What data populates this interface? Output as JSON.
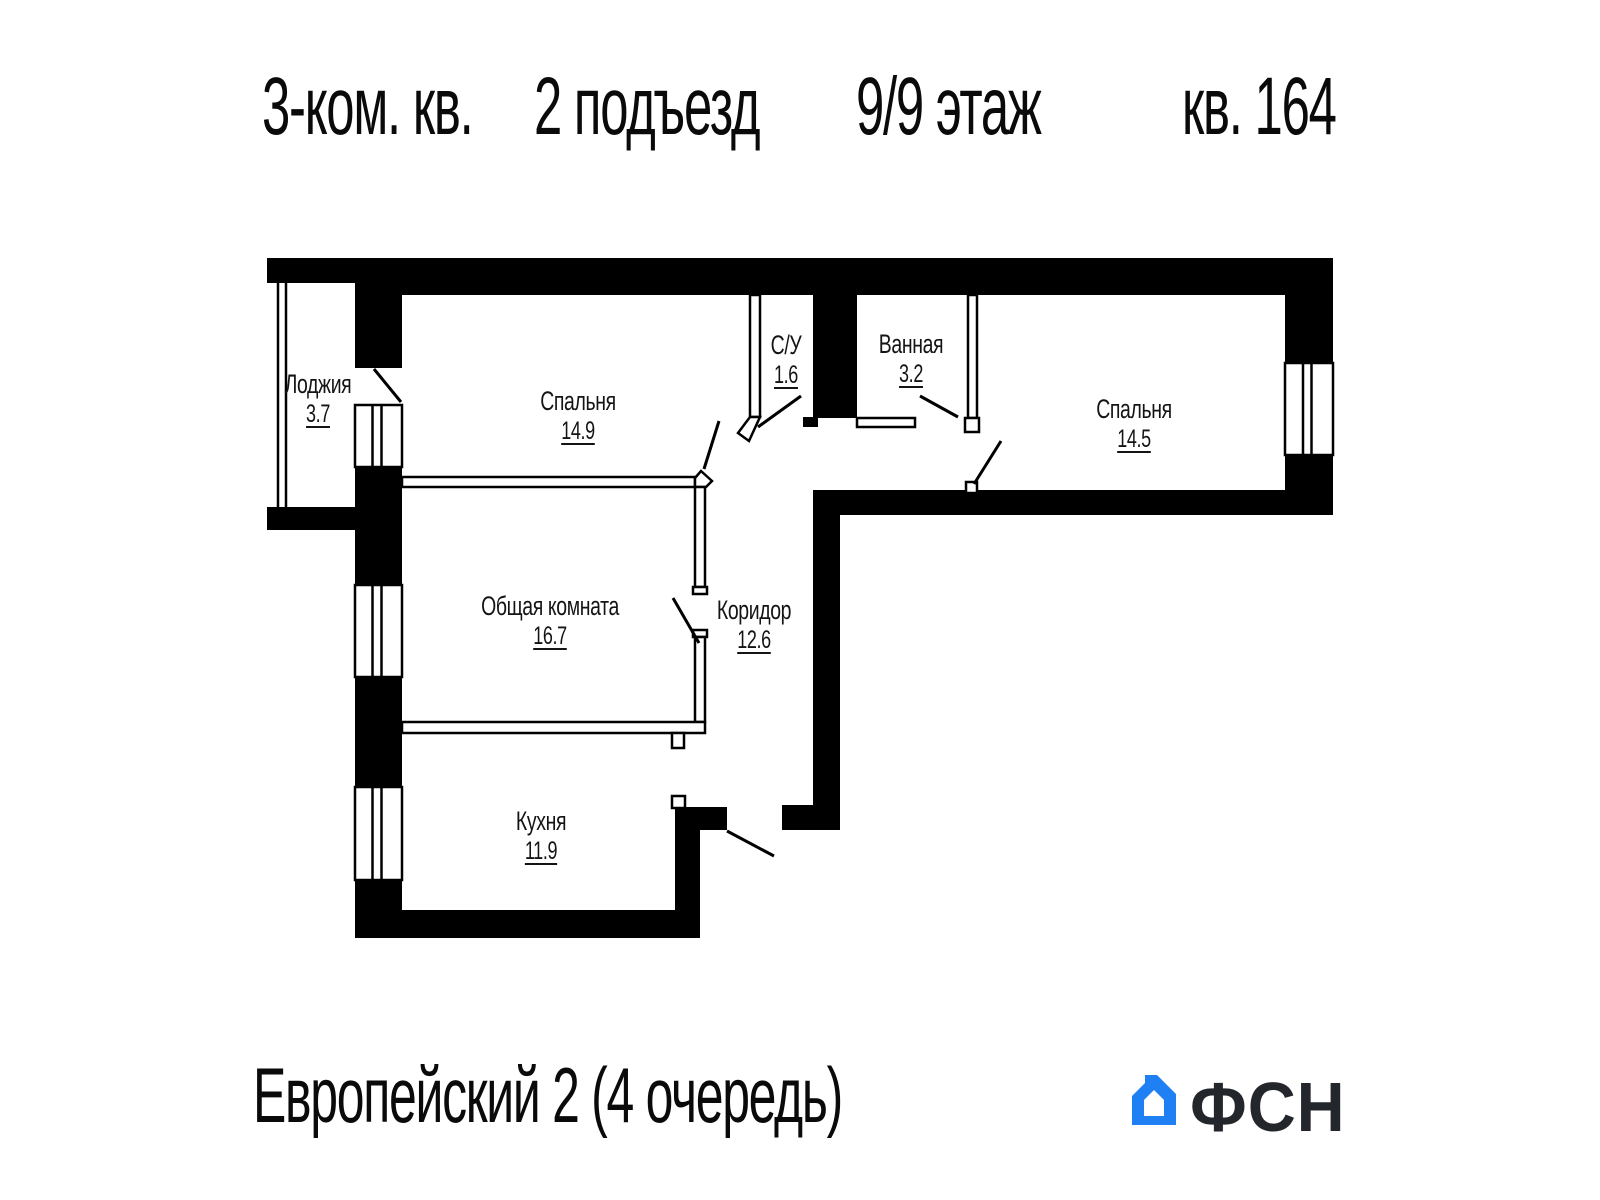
{
  "header": {
    "title_parts": [
      "3-ком. кв.",
      "2 подъезд",
      "9/9 этаж",
      "кв. 164"
    ]
  },
  "rooms": [
    {
      "name": "Лоджия",
      "area": "3.7"
    },
    {
      "name": "Спальня",
      "area": "14.9"
    },
    {
      "name": "С/У",
      "area": "1.6"
    },
    {
      "name": "Ванная",
      "area": "3.2"
    },
    {
      "name": "Спальня",
      "area": "14.5"
    },
    {
      "name": "Общая комната",
      "area": "16.7"
    },
    {
      "name": "Коридор",
      "area": "12.6"
    },
    {
      "name": "Кухня",
      "area": "11.9"
    }
  ],
  "footer": {
    "project": "Европейский 2 (4 очередь)",
    "logo_text": "ФСН"
  },
  "colors": {
    "walls": "#000000",
    "thin_wall_fill": "#ffffff",
    "logo_blue": "#1e80f2",
    "logo_dark": "#23262b"
  },
  "icons": {
    "logo_house": "house-icon"
  }
}
